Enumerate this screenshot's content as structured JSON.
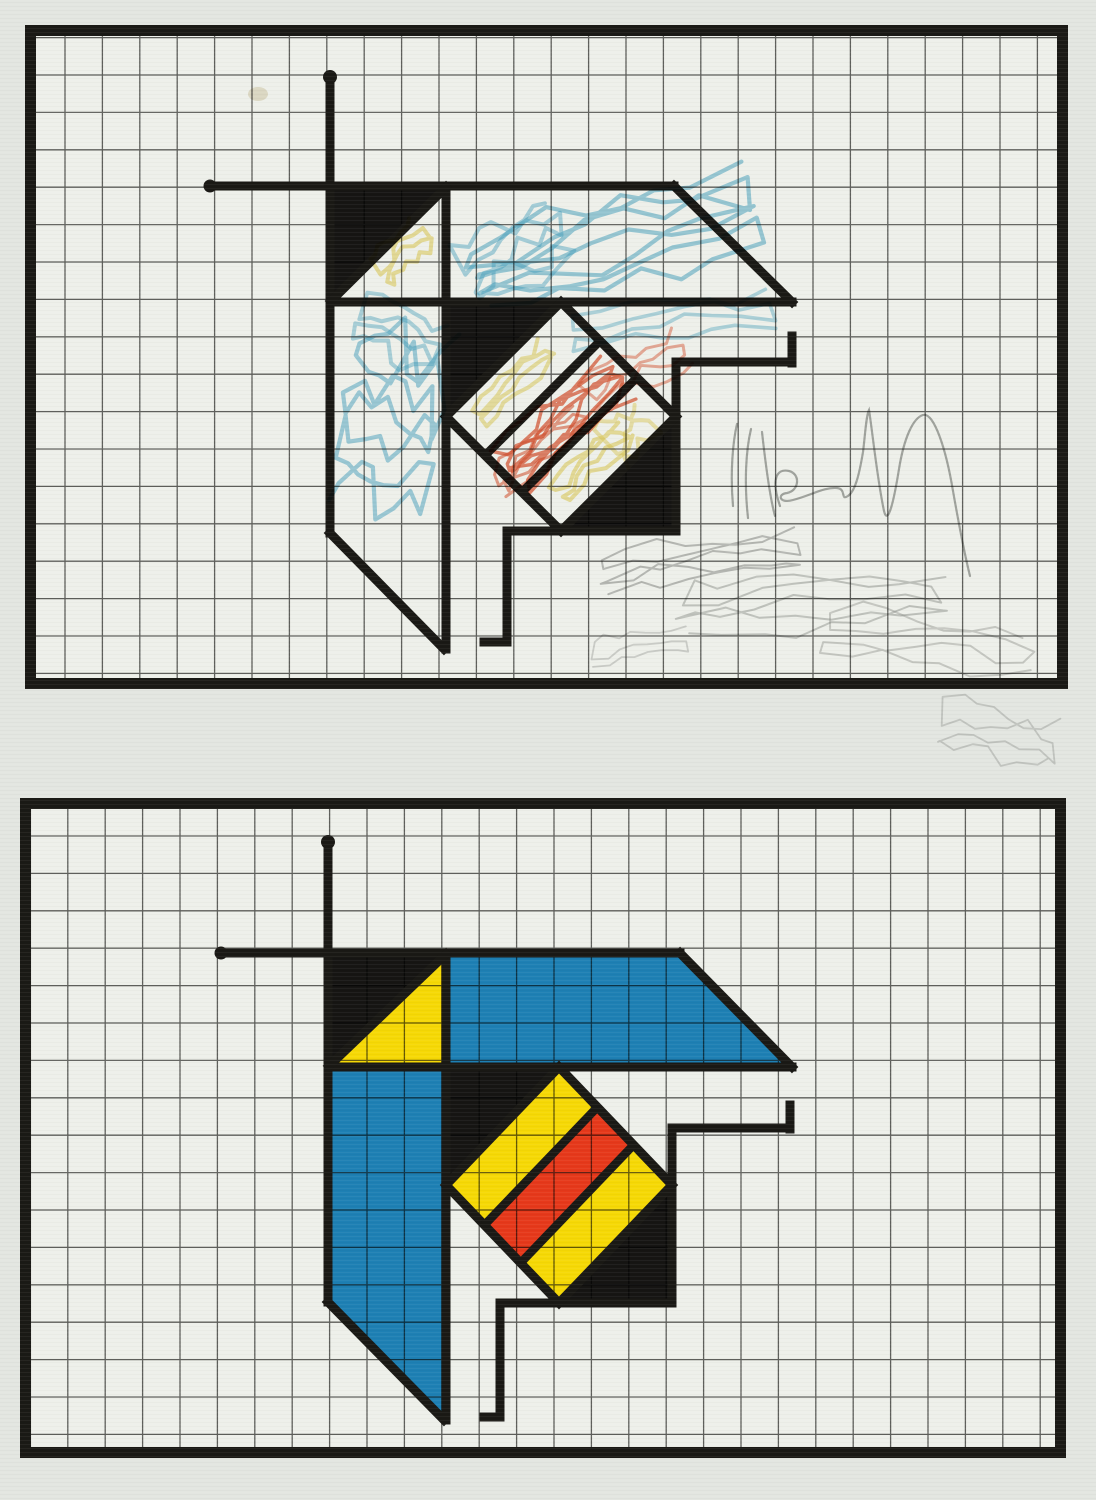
{
  "artwork": {
    "canvas": {
      "width": 1096,
      "height": 1500,
      "background": "#e3e6e1",
      "paper": "#eef0ea"
    },
    "palette": {
      "ink": "#1a1915",
      "grid": "#3e3e3b",
      "blue": "#1e80b4",
      "yellow": "#f6d906",
      "red": "#e6391b",
      "black": "#161513",
      "crayon_blue": "#3fa3c8",
      "crayon_red": "#df512d",
      "crayon_yellow": "#e6cf52",
      "pencil": "#8e908e",
      "stain": "#d8cba9"
    },
    "panels": [
      {
        "name": "top-sketch",
        "frame": {
          "x": 30.5,
          "y": 30.5,
          "w": 1032,
          "h": 653,
          "stroke": 11
        },
        "grid": {
          "step": 37.4,
          "x_start": 27.6,
          "y_start": 37.6,
          "width": 1.3,
          "opacity": 0.8
        },
        "figure": {
          "mode": "sketch",
          "fills": [
            {
              "color": "black",
              "points": [
                [
                  330,
                  186
                ],
                [
                  446,
                  186
                ],
                [
                  330,
                  302
                ]
              ]
            },
            {
              "color": "black",
              "rect": [
                446,
                302,
                115,
                114.5
              ]
            },
            {
              "color": "black",
              "rect": [
                561,
                416.5,
                115,
                114.5
              ]
            },
            {
              "color": "paper",
              "points": [
                [
                  561,
                  302
                ],
                [
                  676,
                  416.5
                ],
                [
                  561,
                  531
                ],
                [
                  446,
                  416.5
                ]
              ]
            }
          ],
          "lines": [
            [
              210,
              186,
              674,
              186
            ],
            [
              674,
              186,
              792,
              302
            ],
            [
              792,
              302,
              330,
              302
            ],
            [
              330,
              77,
              330,
              533
            ],
            [
              330,
              533,
              444,
              649
            ],
            [
              446,
              186,
              446,
              649
            ],
            [
              446,
              187,
              331,
              301
            ],
            [
              792,
              336,
              792,
              363
            ],
            [
              791,
              362,
              676,
              362
            ],
            [
              676,
              362,
              676,
              531
            ],
            [
              676,
              531,
              507,
              531
            ],
            [
              507,
              531,
              507,
              642
            ],
            [
              507,
              642,
              484,
              642
            ]
          ],
          "diamond": {
            "outline": [
              [
                561,
                302
              ],
              [
                676,
                416.5
              ],
              [
                561,
                531
              ],
              [
                446,
                416.5
              ]
            ],
            "chords": [
              [
                600.1,
                340.9,
                485.1,
                455.4
              ],
              [
                636.9,
                377.6,
                521.9,
                492.1
              ]
            ]
          },
          "dots": [
            [
              330,
              77,
              7
            ],
            [
              210,
              186,
              6.5
            ]
          ]
        }
      },
      {
        "name": "bottom-painted",
        "frame": {
          "x": 25.5,
          "y": 803.5,
          "w": 1035,
          "h": 649,
          "stroke": 11
        },
        "grid": {
          "step": 37.4,
          "x_start": 30.4,
          "y_start": 798.6,
          "width": 1.3,
          "opacity": 0.8
        },
        "figure": {
          "mode": "painted",
          "fills": [
            {
              "color": "black",
              "points": [
                [
                  328,
                  953
                ],
                [
                  446,
                  953
                ],
                [
                  328,
                  1067
                ]
              ]
            },
            {
              "color": "yellow",
              "points": [
                [
                  446,
                  953
                ],
                [
                  446,
                  1067
                ],
                [
                  328,
                  1067
                ]
              ]
            },
            {
              "color": "blue",
              "points": [
                [
                  446,
                  953
                ],
                [
                  680,
                  953
                ],
                [
                  792,
                  1067
                ],
                [
                  446,
                  1067
                ]
              ]
            },
            {
              "color": "blue",
              "points": [
                [
                  328,
                  1067
                ],
                [
                  446,
                  1067
                ],
                [
                  446,
                  1420
                ],
                [
                  443,
                  1420
                ],
                [
                  328,
                  1302
                ]
              ]
            },
            {
              "color": "black",
              "rect": [
                446,
                1067,
                113,
                118
              ]
            },
            {
              "color": "black",
              "rect": [
                559,
                1185,
                113,
                118
              ]
            },
            {
              "color": "yellow",
              "points": [
                [
                  559,
                  1067
                ],
                [
                  597.4,
                  1107.1
                ],
                [
                  484.4,
                  1225.1
                ],
                [
                  446,
                  1185
                ]
              ]
            },
            {
              "color": "red",
              "points": [
                [
                  597.4,
                  1107.1
                ],
                [
                  633.6,
                  1144.9
                ],
                [
                  520.6,
                  1262.9
                ],
                [
                  484.4,
                  1225.1
                ]
              ]
            },
            {
              "color": "yellow",
              "points": [
                [
                  633.6,
                  1144.9
                ],
                [
                  672,
                  1185
                ],
                [
                  559,
                  1303
                ],
                [
                  520.6,
                  1262.9
                ]
              ]
            }
          ],
          "lines": [
            [
              221,
              953,
              680,
              953
            ],
            [
              680,
              953,
              792,
              1067
            ],
            [
              792,
              1067,
              328,
              1067
            ],
            [
              328,
              842,
              328,
              1302
            ],
            [
              328,
              1302,
              444,
              1420
            ],
            [
              446,
              953,
              446,
              1420
            ],
            [
              446,
              954,
              329,
              1066
            ],
            [
              790,
              1105,
              790,
              1129
            ],
            [
              790,
              1128,
              672,
              1128
            ],
            [
              672,
              1128,
              672,
              1303
            ],
            [
              672,
              1303,
              500,
              1303
            ],
            [
              500,
              1303,
              500,
              1417
            ],
            [
              500,
              1417,
              484,
              1417
            ]
          ],
          "diamond": {
            "outline": [
              [
                559,
                1067
              ],
              [
                672,
                1185
              ],
              [
                559,
                1303
              ],
              [
                446,
                1185
              ]
            ],
            "chords": [
              [
                597.4,
                1107.1,
                484.4,
                1225.1
              ],
              [
                633.6,
                1144.9,
                520.6,
                1262.9
              ]
            ]
          },
          "dots": [
            [
              328,
              842,
              7
            ],
            [
              221,
              953,
              6.5
            ]
          ]
        }
      }
    ],
    "scribbles": [
      {
        "color": "crayon_blue",
        "cx": 612,
        "cy": 242,
        "rx": 150,
        "ry": 52,
        "angle": -16,
        "n": 7,
        "w": 4.2,
        "o": 0.5,
        "seed": 1
      },
      {
        "color": "crayon_blue",
        "cx": 516,
        "cy": 252,
        "rx": 58,
        "ry": 46,
        "angle": -28,
        "n": 5,
        "w": 4,
        "o": 0.42,
        "seed": 2
      },
      {
        "color": "crayon_blue",
        "cx": 672,
        "cy": 320,
        "rx": 105,
        "ry": 25,
        "angle": -7,
        "n": 4,
        "w": 3.6,
        "o": 0.38,
        "seed": 3
      },
      {
        "color": "crayon_blue",
        "cx": 390,
        "cy": 420,
        "rx": 52,
        "ry": 108,
        "angle": 12,
        "n": 7,
        "w": 4.2,
        "o": 0.48,
        "seed": 4
      },
      {
        "color": "crayon_blue",
        "cx": 398,
        "cy": 332,
        "rx": 46,
        "ry": 36,
        "angle": 24,
        "n": 4,
        "w": 4,
        "o": 0.4,
        "seed": 5
      },
      {
        "color": "crayon_yellow",
        "cx": 402,
        "cy": 252,
        "rx": 32,
        "ry": 24,
        "angle": -45,
        "n": 4,
        "w": 4,
        "o": 0.55,
        "seed": 6
      },
      {
        "color": "crayon_yellow",
        "cx": 514,
        "cy": 382,
        "rx": 52,
        "ry": 17,
        "angle": -45,
        "n": 4,
        "w": 4,
        "o": 0.5,
        "seed": 7
      },
      {
        "color": "crayon_yellow",
        "cx": 590,
        "cy": 462,
        "rx": 50,
        "ry": 20,
        "angle": -45,
        "n": 4,
        "w": 4,
        "o": 0.55,
        "seed": 8
      },
      {
        "color": "crayon_yellow",
        "cx": 628,
        "cy": 432,
        "rx": 26,
        "ry": 34,
        "angle": -40,
        "n": 3,
        "w": 4,
        "o": 0.45,
        "seed": 9
      },
      {
        "color": "crayon_red",
        "cx": 564,
        "cy": 420,
        "rx": 76,
        "ry": 32,
        "angle": -42,
        "n": 8,
        "w": 3.4,
        "o": 0.7,
        "seed": 10
      },
      {
        "color": "crayon_red",
        "cx": 540,
        "cy": 450,
        "rx": 58,
        "ry": 24,
        "angle": -42,
        "n": 5,
        "w": 3,
        "o": 0.55,
        "seed": 11
      },
      {
        "color": "crayon_red",
        "cx": 636,
        "cy": 372,
        "rx": 58,
        "ry": 28,
        "angle": -30,
        "n": 4,
        "w": 3,
        "o": 0.45,
        "seed": 12
      },
      {
        "color": "pencil",
        "cx": 700,
        "cy": 560,
        "rx": 102,
        "ry": 30,
        "angle": -8,
        "n": 5,
        "w": 2,
        "o": 0.55,
        "seed": 13
      },
      {
        "color": "pencil",
        "cx": 812,
        "cy": 602,
        "rx": 138,
        "ry": 36,
        "angle": -4,
        "n": 5,
        "w": 2,
        "o": 0.45,
        "seed": 14
      },
      {
        "color": "pencil",
        "cx": 928,
        "cy": 644,
        "rx": 108,
        "ry": 38,
        "angle": 6,
        "n": 4,
        "w": 2,
        "o": 0.4,
        "seed": 15
      },
      {
        "color": "pencil",
        "cx": 998,
        "cy": 734,
        "rx": 64,
        "ry": 36,
        "angle": 10,
        "n": 4,
        "w": 1.8,
        "o": 0.35,
        "seed": 16
      },
      {
        "color": "pencil",
        "cx": 640,
        "cy": 646,
        "rx": 52,
        "ry": 20,
        "angle": -10,
        "n": 3,
        "w": 1.8,
        "o": 0.35,
        "seed": 17
      }
    ],
    "signature": {
      "color": "pencil",
      "width": 2.2,
      "opacity": 0.75,
      "path": "M733,506 C730,472 733,441 737,424 M748,518 C744,482 746,450 751,429 M762,432 C766,468 770,498 775,516 M780,506 C771,480 776,468 789,471 C801,474 799,491 787,493 C777,494 779,504 793,500 C812,495 824,487 837,488 C847,489 840,501 848,496 C855,491 859,476 863,452 C865,437 866,416 869,410 C872,428 877,478 884,511 C888,527 894,500 899,469 C904,438 913,418 923,415 C934,412 946,449 953,491 C959,525 965,556 970,576"
    },
    "stain": {
      "cx": 258,
      "cy": 94,
      "rx": 10,
      "ry": 7,
      "opacity": 0.5
    }
  }
}
